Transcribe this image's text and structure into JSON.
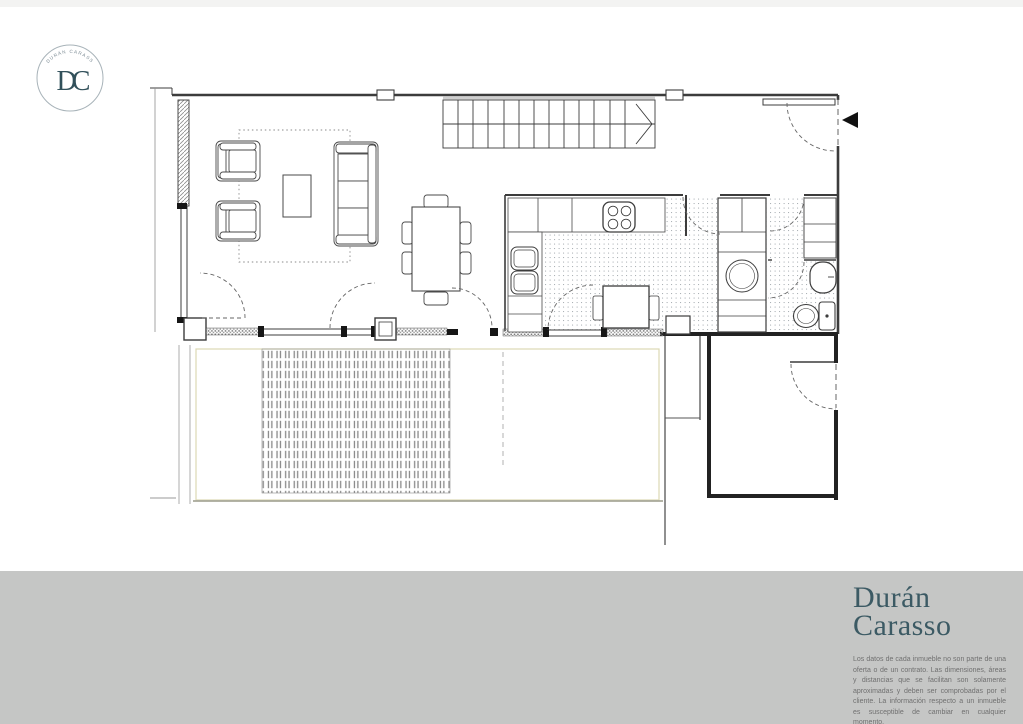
{
  "brand": {
    "logo_arc_text": "DURÁN CARASSO",
    "monogram": "DC",
    "colors": {
      "brand_teal": "#35535E",
      "logo_ring": "#A8B3B9",
      "footer_band": "#C5C6C5",
      "disclaimer_gray": "#707070",
      "plan_line": "#3C3C3C",
      "terrace_outline": "#DCD9B4"
    }
  },
  "footer": {
    "wordmark_line1": "Durán",
    "wordmark_line2": "Carasso",
    "disclaimer": "Los datos de cada inmueble no son parte de una oferta o de un contrato. Las dimensiones, áreas y distancias que se facilitan son solamente aproximadas y deben ser comprobadas por el cliente. La información respecto a un inmueble es susceptible de cambiar en cualquier momento."
  },
  "floor_plan": {
    "type": "architectural-floor-plan",
    "features": [
      "exterior-walls",
      "staircase-with-direction-arrow",
      "living-area-rug",
      "two-armchairs",
      "coffee-table",
      "three-seat-sofa",
      "dining-table-six-chairs",
      "kitchen-counter",
      "cooktop-four-burners",
      "double-sink",
      "breakfast-table-two-chairs",
      "appliance-column",
      "washing-machine",
      "hallway",
      "bathroom-washbasin",
      "toilet",
      "entrance-door",
      "entrance-arrow",
      "door-swing-arcs",
      "window-bands",
      "terrace",
      "wood-deck",
      "terrace-divider-wall",
      "neighbor-room-with-door"
    ]
  }
}
